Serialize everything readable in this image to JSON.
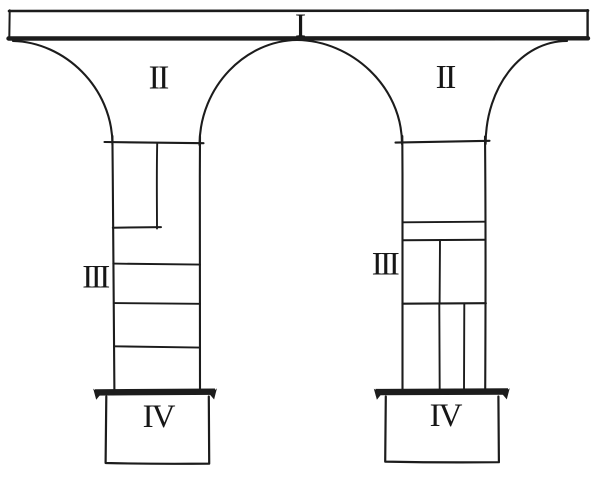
{
  "diagram": {
    "description": "Hand-drawn schematic of two flared piers supporting a horizontal beam, regions numbered I-IV",
    "background_color": "#ffffff",
    "ink_color": "#1c1c1c",
    "text_color": "#161616",
    "labels": {
      "beam": "I",
      "left_flare": "II",
      "right_flare": "II",
      "left_shaft": "III",
      "right_shaft": "III",
      "left_base": "IV",
      "right_base": "IV"
    }
  }
}
